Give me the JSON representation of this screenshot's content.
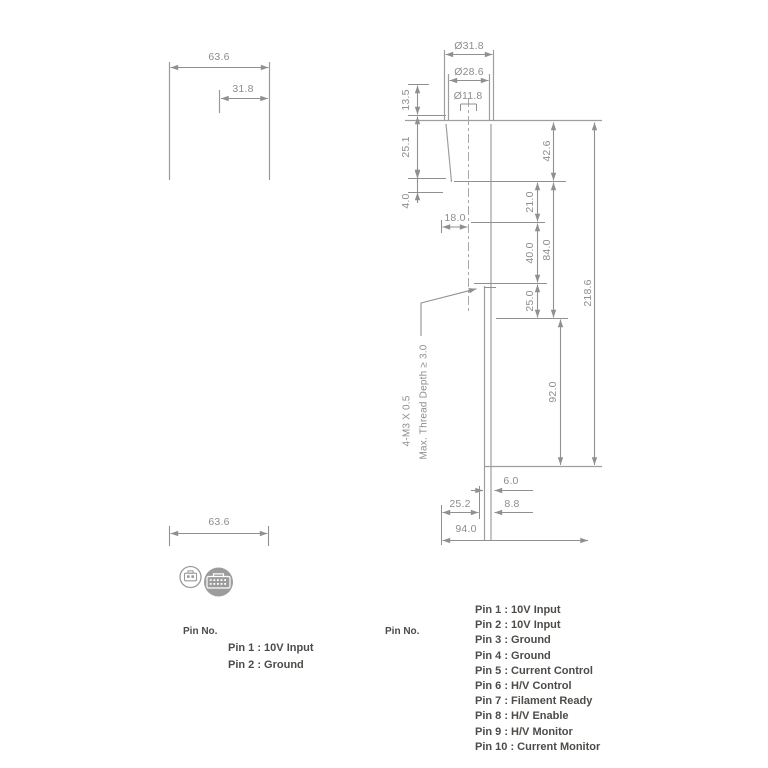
{
  "front_view": {
    "width": "63.6",
    "half_width": "31.8"
  },
  "bottom_view": {
    "width": "63.6",
    "pin_label": "Pin No.",
    "pins": [
      "Pin 1 : 10V Input",
      "Pin 2 : Ground"
    ]
  },
  "side_view": {
    "dia_outer": "Ø31.8",
    "dia_mid": "Ø28.6",
    "dia_window": "Ø11.8",
    "h_135": "13.5",
    "h_251": "25.1",
    "h_40": "4.0",
    "w_180": "18.0",
    "v_426": "42.6",
    "v_210": "21.0",
    "v_400": "40.0",
    "v_250": "25.0",
    "v_840": "84.0",
    "v_920": "92.0",
    "v_2186": "218.6",
    "b_60": "6.0",
    "b_88": "8.8",
    "b_252": "25.2",
    "b_940": "94.0",
    "note_line1": "4-M3 X 0.5",
    "note_line2": "Max. Thread Depth ≥ 3.0",
    "pin_label": "Pin No.",
    "pins": [
      "Pin 1 : 10V Input",
      "Pin 2 : 10V Input",
      "Pin 3 : Ground",
      "Pin 4 : Ground",
      "Pin 5 : Current Control",
      "Pin 6 : H/V Control",
      "Pin 7 : Filament Ready",
      "Pin 8 : H/V Enable",
      "Pin 9 : H/V Monitor",
      "Pin 10 : Current Monitor"
    ]
  },
  "colors": {
    "dim_line": "#909090",
    "outline": "#a0a0a0",
    "dim_text": "#8d8d8d",
    "pin_text": "#4e4b48",
    "connector_fill": "#9c9c9c"
  }
}
